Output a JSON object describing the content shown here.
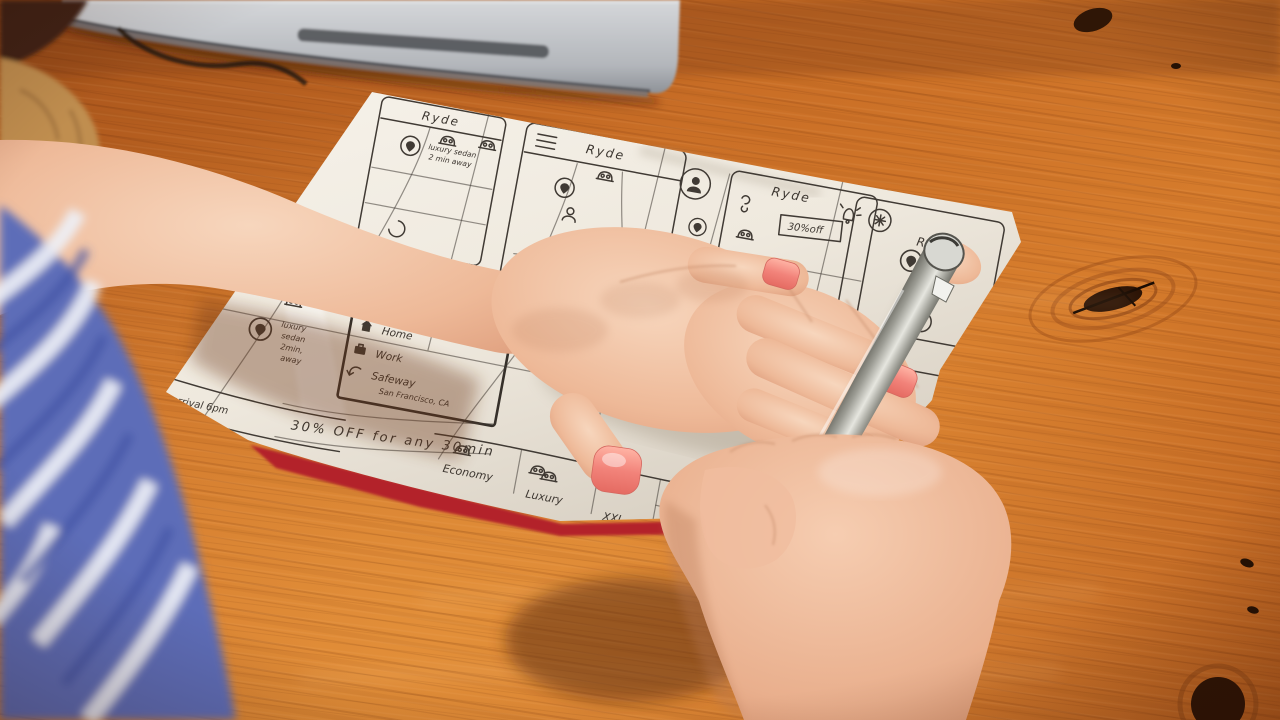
{
  "sketch": {
    "f1": {
      "title": "Ryde",
      "note1": "luxury sedan",
      "note2": "2 min away"
    },
    "f2": {
      "title": "Ryde"
    },
    "f4": {
      "title": "Ryde",
      "promo": "30%off"
    },
    "f5": {
      "title": "Ryde",
      "pickup1": "Pickup",
      "pickup2": "in 3",
      "row1": "Cars Ne",
      "row2": "und",
      "price1": "$18",
      "price2": "$30"
    },
    "fa": {
      "note1": "luxury",
      "note2": "sedan",
      "note3": "2min,",
      "note4": "away",
      "bottom": "arrival  6pm"
    },
    "fb": {
      "home": "Home",
      "work": "Work",
      "place1": "Safeway",
      "place2": "San Francisco, CA",
      "banner": "30% OFF for any 30min"
    },
    "fc": {
      "tab1": "Economy",
      "tab2": "Luxury",
      "tab3": "XXL",
      "cell": "4 seat"
    }
  },
  "icons": {
    "menu": "hamburger-menu",
    "pin": "location-pin",
    "car": "car",
    "profile": "person",
    "bell": "notification-bell",
    "gear": "settings-gear",
    "lock": "keyhole-lock",
    "home": "home",
    "work": "briefcase",
    "history": "recent-arrow",
    "close": "close-x"
  },
  "colors": {
    "wood": "#c8702a",
    "paper": "#f4efe6",
    "ink": "#403a34",
    "red_sheet": "#b3202c",
    "fabric_blue": "#6273bd",
    "nail_polish": "#f2837a",
    "pen_silver": "#a8a8a0",
    "laptop_silver": "#b7bac0"
  }
}
